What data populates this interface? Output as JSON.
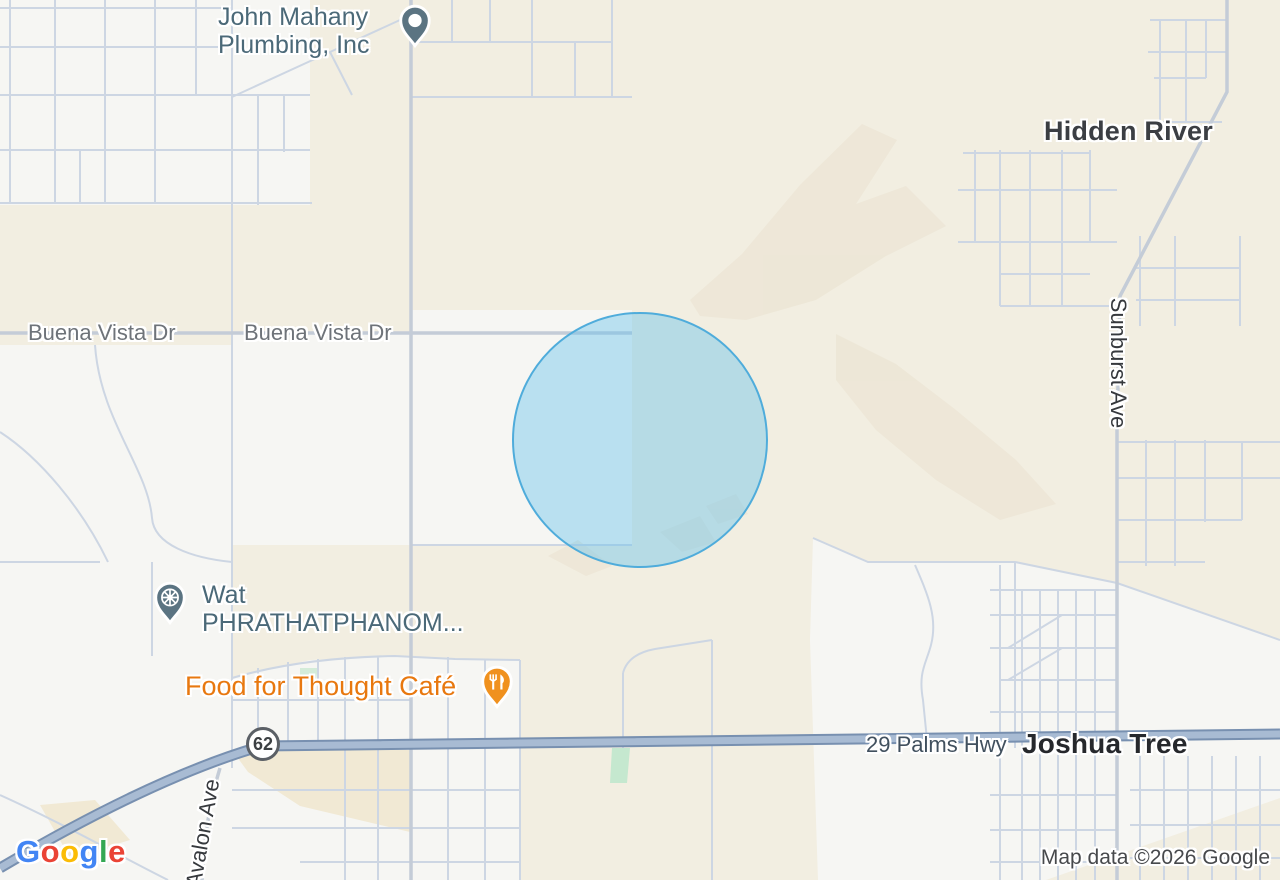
{
  "map": {
    "locality_labels": [
      {
        "text": "Hidden River"
      },
      {
        "text": "Joshua Tree"
      }
    ],
    "road_labels": [
      {
        "text": "Buena Vista Dr"
      },
      {
        "text": "Buena Vista Dr"
      },
      {
        "text": "Sunburst Ave"
      },
      {
        "text": "29 Palms Hwy"
      },
      {
        "text": "Avalon Ave"
      }
    ],
    "route_shield": {
      "number": "62"
    },
    "pois": [
      {
        "line1": "John Mahany",
        "line2": "Plumbing, Inc",
        "category": "plumber"
      },
      {
        "line1": "Wat",
        "line2": "PHRATHATPHANOM...",
        "category": "place-of-worship"
      },
      {
        "line1": "Food for Thought Café",
        "category": "restaurant"
      }
    ],
    "colors": {
      "poi_pin_slate": "#5b7482",
      "poi_text_slate": "#4b6978",
      "restaurant_pin_orange": "#f0911e",
      "restaurant_text_orange": "#e8780f",
      "radius_circle_fill": "#64c0eb",
      "radius_circle_stroke": "#4facdb",
      "highway_fill": "#a8bbd3",
      "highway_casing": "#7890b0",
      "urban_area": "#f6f6f3",
      "desert_background": "#f2eee1"
    }
  },
  "attribution": {
    "logo_letters": [
      "G",
      "o",
      "o",
      "g",
      "l",
      "e"
    ],
    "map_data_text": "Map data ©2026 Google"
  }
}
